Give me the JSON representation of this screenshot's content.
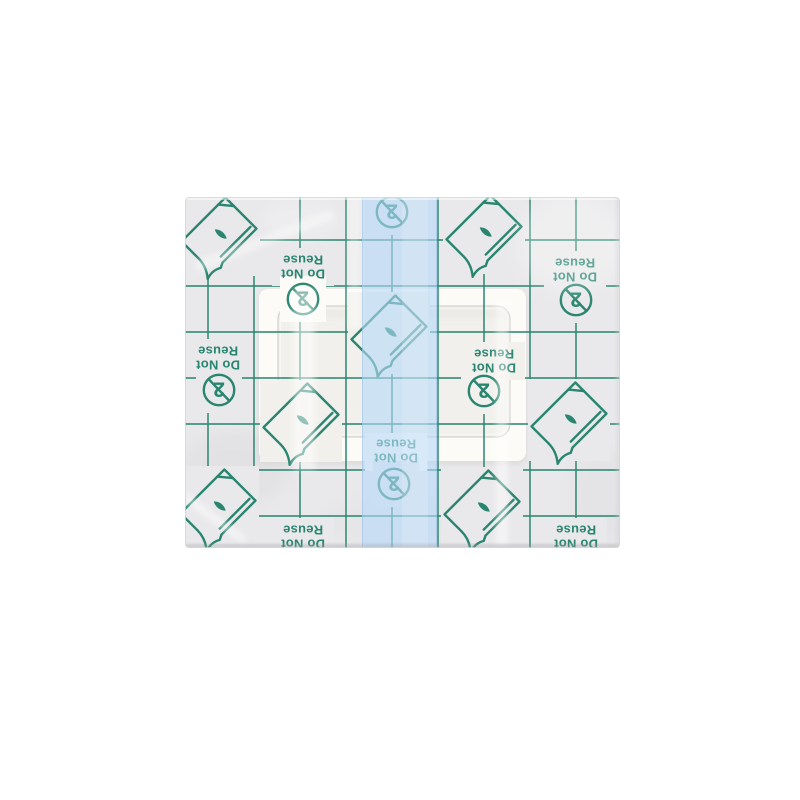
{
  "image": {
    "subject": "transparent adhesive wound dressing with printed release liner",
    "background": "#ffffff"
  },
  "product": {
    "liner_print": {
      "warning_line1": "Do Not",
      "warning_line2": "Reuse",
      "single_use_numeral": "2"
    },
    "colors": {
      "print_green": "#2a8570",
      "liner_gray": "#e9e9eb",
      "stripe_blue": "#b5d8f8",
      "pad_white": "#fcfbf7",
      "window_gray": "#f1f0ec",
      "background": "#ffffff",
      "edge_shadow": "#9a9aa0"
    }
  },
  "icons": {
    "peel_icon": "dressing-film-with-peeling-corner",
    "do_not_reuse_icon": "crossed-out-numeral-2-in-circle"
  }
}
